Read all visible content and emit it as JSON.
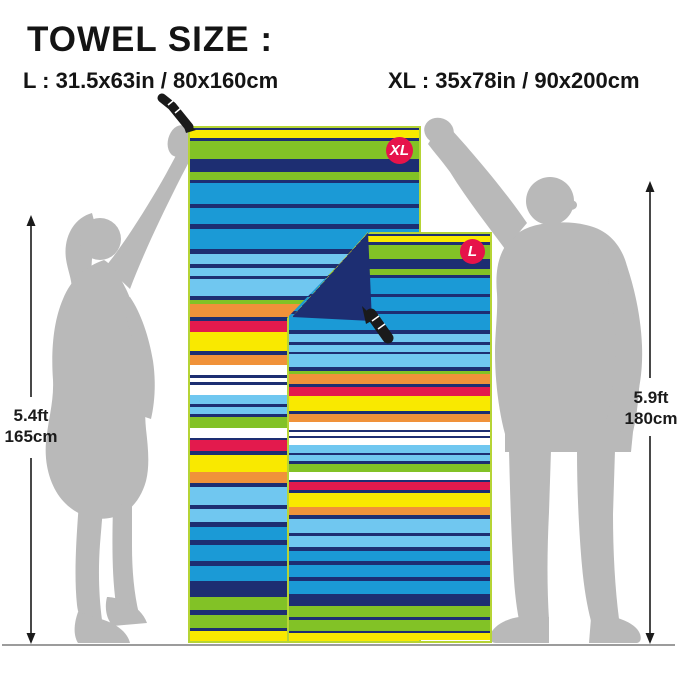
{
  "title": "TOWEL SIZE :",
  "sizes": {
    "l_label": "L : 31.5x63in / 80x160cm",
    "xl_label": "XL : 35x78in / 90x200cm"
  },
  "badges": {
    "xl": "XL",
    "l": "L"
  },
  "measurements": {
    "left": {
      "ft": "5.4ft",
      "cm": "165cm"
    },
    "right": {
      "ft": "5.9ft",
      "cm": "180cm"
    }
  },
  "palette": {
    "yellow": "#f9e900",
    "green": "#82c226",
    "navy": "#1d2e72",
    "blue": "#1b9ad6",
    "sky": "#70c7f0",
    "orange": "#f0923a",
    "red": "#e31a4d",
    "white": "#ffffff",
    "silhouette": "#b9b9b9",
    "ground": "#9c9c9c",
    "badge_red": "#e6134a",
    "text_black": "#1b1b1b",
    "zipper_black": "#1a1a1a",
    "towel_border": "#b6d435"
  },
  "towel_pattern": [
    {
      "c": "navy",
      "w": 2
    },
    {
      "c": "yellow",
      "w": 8
    },
    {
      "c": "navy",
      "w": 3
    },
    {
      "c": "green",
      "w": 17
    },
    {
      "c": "navy",
      "w": 12
    },
    {
      "c": "green",
      "w": 8
    },
    {
      "c": "navy",
      "w": 3
    },
    {
      "c": "blue",
      "w": 20
    },
    {
      "c": "navy",
      "w": 4
    },
    {
      "c": "blue",
      "w": 16
    },
    {
      "c": "navy",
      "w": 4
    },
    {
      "c": "blue",
      "w": 20
    },
    {
      "c": "navy",
      "w": 4
    },
    {
      "c": "sky",
      "w": 10
    },
    {
      "c": "navy",
      "w": 4
    },
    {
      "c": "sky",
      "w": 8
    },
    {
      "c": "navy",
      "w": 3
    },
    {
      "c": "sky",
      "w": 16
    },
    {
      "c": "navy",
      "w": 4
    },
    {
      "c": "green",
      "w": 4
    },
    {
      "c": "orange",
      "w": 12
    },
    {
      "c": "navy",
      "w": 4
    },
    {
      "c": "red",
      "w": 11
    },
    {
      "c": "yellow",
      "w": 18
    },
    {
      "c": "navy",
      "w": 4
    },
    {
      "c": "orange",
      "w": 9
    },
    {
      "c": "white",
      "w": 10
    },
    {
      "c": "navy",
      "w": 3
    },
    {
      "c": "white",
      "w": 4
    },
    {
      "c": "navy",
      "w": 3
    },
    {
      "c": "white",
      "w": 9
    },
    {
      "c": "sky",
      "w": 9
    },
    {
      "c": "navy",
      "w": 3
    },
    {
      "c": "sky",
      "w": 7
    },
    {
      "c": "navy",
      "w": 3
    },
    {
      "c": "green",
      "w": 10
    },
    {
      "c": "white",
      "w": 10
    },
    {
      "c": "navy",
      "w": 2
    },
    {
      "c": "red",
      "w": 10
    },
    {
      "c": "navy",
      "w": 4
    },
    {
      "c": "yellow",
      "w": 17
    },
    {
      "c": "orange",
      "w": 10
    },
    {
      "c": "navy",
      "w": 4
    },
    {
      "c": "sky",
      "w": 17
    },
    {
      "c": "navy",
      "w": 4
    },
    {
      "c": "sky",
      "w": 13
    },
    {
      "c": "navy",
      "w": 5
    },
    {
      "c": "blue",
      "w": 12
    },
    {
      "c": "navy",
      "w": 5
    },
    {
      "c": "blue",
      "w": 15
    },
    {
      "c": "navy",
      "w": 5
    },
    {
      "c": "blue",
      "w": 15
    },
    {
      "c": "navy",
      "w": 15
    },
    {
      "c": "green",
      "w": 13
    },
    {
      "c": "navy",
      "w": 4
    },
    {
      "c": "green",
      "w": 13
    },
    {
      "c": "navy",
      "w": 3
    },
    {
      "c": "yellow",
      "w": 9
    }
  ],
  "fold": {
    "stripes": [
      {
        "c": "navy",
        "w": 3
      },
      {
        "c": "sky",
        "w": 7
      },
      {
        "c": "navy",
        "w": 3
      },
      {
        "c": "blue",
        "w": 8
      },
      {
        "c": "navy",
        "w": 3
      },
      {
        "c": "green",
        "w": 15
      },
      {
        "c": "navy",
        "w": 3
      },
      {
        "c": "green",
        "w": 9
      },
      {
        "c": "navy",
        "w": 3
      },
      {
        "c": "yellow",
        "w": 8
      },
      {
        "c": "navy",
        "w": 60
      }
    ],
    "angle_deg": 132
  }
}
